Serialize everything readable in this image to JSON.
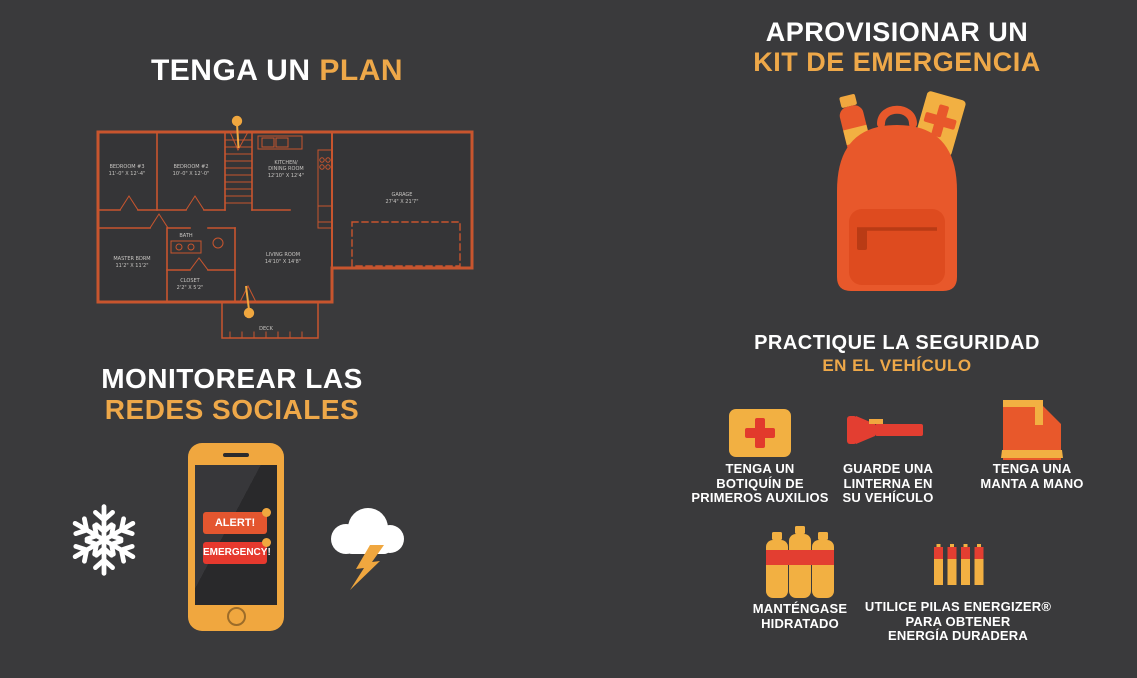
{
  "colors": {
    "background": "#3A3A3C",
    "accent_text": "#EEA849",
    "amber": "#F0A73F",
    "icon_amber": "#F2B042",
    "orange": "#E8582B",
    "red": "#E6392E",
    "floorplan_line": "#C8552E",
    "white": "#FFFFFF"
  },
  "sections": {
    "plan": {
      "title_white": "TENGA UN",
      "title_accent": "PLAN",
      "floorplan": {
        "rooms": [
          {
            "line1": "BEDROOM #3",
            "line2": "11'-0\" X 12'-4\""
          },
          {
            "line1": "BEDROOM #2",
            "line2": "10'-0\" X 12'-0\""
          },
          {
            "line1": "KITCHEN/",
            "line2": "DINING ROOM",
            "line3": "12'10\" X 12'4\""
          },
          {
            "line1": "GARAGE",
            "line2": "27'4\" X 21'7\""
          },
          {
            "line1": "MASTER BDRM",
            "line2": "11'2\" X 11'2\""
          },
          {
            "line1": "BATH"
          },
          {
            "line1": "LIVING ROOM",
            "line2": "14'10\" X 14'8\""
          },
          {
            "line1": "CLOSET",
            "line2": "2'2\" X 5'2\""
          },
          {
            "line1": "DECK"
          }
        ]
      }
    },
    "social": {
      "title_white": "MONITOREAR LAS",
      "title_accent": "REDES SOCIALES",
      "phone": {
        "alert": "ALERT!",
        "emergency": "EMERGENCY!"
      }
    },
    "kit": {
      "title_white": "APROVISIONAR UN",
      "title_accent": "KIT DE EMERGENCIA"
    },
    "vehicle": {
      "title_white": "PRACTIQUE LA SEGURIDAD",
      "title_accent": "EN EL VEHÍCULO",
      "items": [
        {
          "icon": "first-aid-kit-icon",
          "label": "TENGA UN\nBOTIQUÍN DE\nPRIMEROS AUXILIOS"
        },
        {
          "icon": "flashlight-icon",
          "label": "GUARDE UNA\nLINTERNA EN\nSU VEHÍCULO"
        },
        {
          "icon": "blanket-icon",
          "label": "TENGA UNA\nMANTA A MANO"
        },
        {
          "icon": "water-bottles-icon",
          "label": "MANTÉNGASE\nHIDRATADO"
        },
        {
          "icon": "batteries-icon",
          "label": "UTILICE PILAS ENERGIZER®\nPARA OBTENER\nENERGÍA DURADERA"
        }
      ]
    }
  }
}
